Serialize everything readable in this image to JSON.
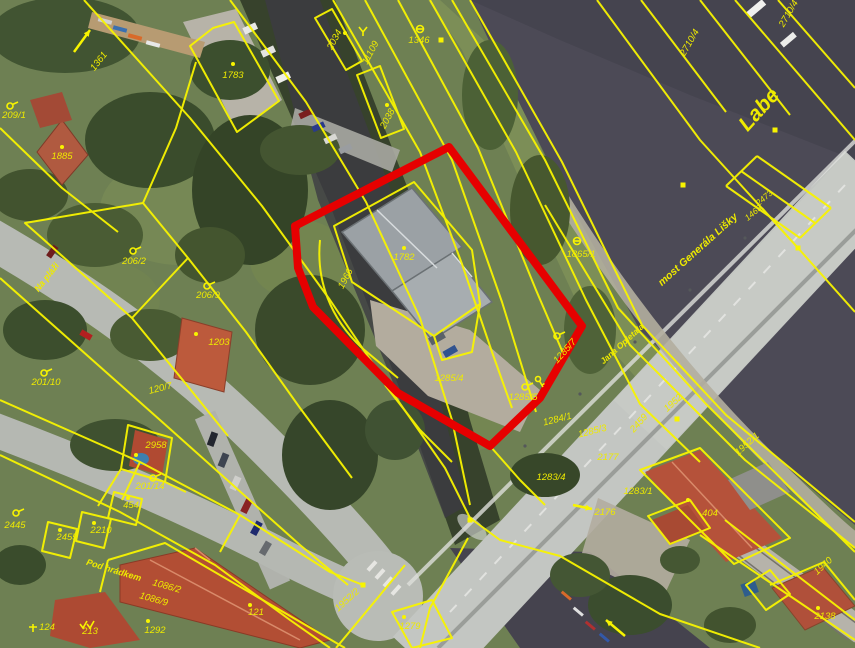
{
  "app": {
    "name": "cadastral-aerial-map-view"
  },
  "map": {
    "colors": {
      "cadastral_line": "#f8f400",
      "label_text": "#eeea00",
      "highlight_outline": "#e60000",
      "water": "#4c4a56",
      "road": "#bcbfb9",
      "grass": "#6e8053"
    },
    "highlighted_parcel_number": "1782",
    "river_name": "Labe",
    "bridge_name": "most Generála Lišky",
    "labels": [
      {
        "kind": "parcel",
        "text": "2034",
        "x": 337,
        "y": 41,
        "rot": -62
      },
      {
        "kind": "parcel",
        "text": "11109",
        "x": 373,
        "y": 54,
        "rot": -62
      },
      {
        "kind": "parcel",
        "text": "1346",
        "x": 419,
        "y": 43,
        "rot": 0
      },
      {
        "kind": "parcel",
        "text": "1783",
        "x": 233,
        "y": 78,
        "rot": 0
      },
      {
        "kind": "parcel",
        "text": "1361",
        "x": 101,
        "y": 63,
        "rot": -52
      },
      {
        "kind": "parcel",
        "text": "209/1",
        "x": 14,
        "y": 118,
        "rot": 0
      },
      {
        "kind": "parcel",
        "text": "1885",
        "x": 62,
        "y": 159,
        "rot": 0
      },
      {
        "kind": "parcel",
        "text": "2710/4",
        "x": 692,
        "y": 44,
        "rot": -60
      },
      {
        "kind": "parcel",
        "text": "2710/4",
        "x": 791,
        "y": 15,
        "rot": -60
      },
      {
        "kind": "river",
        "text": "Labe",
        "x": 764,
        "y": 114,
        "rot": -48,
        "size": 21
      },
      {
        "kind": "street",
        "text": "most Generála Lišky",
        "x": 700,
        "y": 252,
        "rot": -42,
        "size": 10.5
      },
      {
        "kind": "street",
        "text": "Jana Opletala",
        "x": 624,
        "y": 346,
        "rot": -42,
        "size": 8.5
      },
      {
        "kind": "parcel",
        "text": "2473",
        "x": 766,
        "y": 200,
        "rot": -40,
        "size": 8.5
      },
      {
        "kind": "parcel",
        "text": "1463",
        "x": 755,
        "y": 215,
        "rot": -40,
        "size": 8.5
      },
      {
        "kind": "parcel",
        "text": "1865/1",
        "x": 581,
        "y": 257,
        "rot": 0
      },
      {
        "kind": "parcel",
        "text": "2038",
        "x": 390,
        "y": 120,
        "rot": -62
      },
      {
        "kind": "parcel",
        "text": "1966",
        "x": 348,
        "y": 280,
        "rot": -62
      },
      {
        "kind": "parcel",
        "text": "1782",
        "x": 404,
        "y": 260,
        "rot": 0
      },
      {
        "kind": "parcel",
        "text": "1285/4",
        "x": 449,
        "y": 381,
        "rot": 0
      },
      {
        "kind": "parcel",
        "text": "1285/5",
        "x": 523,
        "y": 400,
        "rot": 0
      },
      {
        "kind": "parcel",
        "text": "1285/7",
        "x": 567,
        "y": 353,
        "rot": -48
      },
      {
        "kind": "parcel",
        "text": "206/2",
        "x": 134,
        "y": 264,
        "rot": 0
      },
      {
        "kind": "parcel",
        "text": "206/9",
        "x": 208,
        "y": 298,
        "rot": 0
      },
      {
        "kind": "parcel",
        "text": "1203",
        "x": 219,
        "y": 345,
        "rot": 0
      },
      {
        "kind": "parcel",
        "text": "120/7",
        "x": 161,
        "y": 391,
        "rot": -14
      },
      {
        "kind": "parcel",
        "text": "201/10",
        "x": 46,
        "y": 385,
        "rot": 0
      },
      {
        "kind": "street",
        "text": "Na pláži",
        "x": 49,
        "y": 279,
        "rot": -52,
        "size": 9
      },
      {
        "kind": "parcel",
        "text": "2445",
        "x": 15,
        "y": 528,
        "rot": 0
      },
      {
        "kind": "parcel",
        "text": "2455",
        "x": 67,
        "y": 540,
        "rot": 0
      },
      {
        "kind": "parcel",
        "text": "2210",
        "x": 101,
        "y": 533,
        "rot": 0
      },
      {
        "kind": "parcel",
        "text": "454",
        "x": 131,
        "y": 508,
        "rot": 0
      },
      {
        "kind": "parcel",
        "text": "2958",
        "x": 156,
        "y": 448,
        "rot": 0
      },
      {
        "kind": "parcel",
        "text": "201/14",
        "x": 150,
        "y": 489,
        "rot": 0
      },
      {
        "kind": "street",
        "text": "Pod hrádkem",
        "x": 113,
        "y": 573,
        "rot": 17,
        "size": 9
      },
      {
        "kind": "parcel",
        "text": "1086/2",
        "x": 166,
        "y": 589,
        "rot": 16
      },
      {
        "kind": "parcel",
        "text": "1086/9",
        "x": 153,
        "y": 602,
        "rot": 16
      },
      {
        "kind": "parcel",
        "text": "124",
        "x": 47,
        "y": 630,
        "rot": 0
      },
      {
        "kind": "parcel",
        "text": "213",
        "x": 90,
        "y": 634,
        "rot": 0
      },
      {
        "kind": "parcel",
        "text": "1292",
        "x": 155,
        "y": 633,
        "rot": 0
      },
      {
        "kind": "parcel",
        "text": "121",
        "x": 256,
        "y": 615,
        "rot": 0
      },
      {
        "kind": "parcel",
        "text": "1952/2",
        "x": 349,
        "y": 602,
        "rot": -42
      },
      {
        "kind": "parcel",
        "text": "1279",
        "x": 410,
        "y": 629,
        "rot": 0
      },
      {
        "kind": "parcel",
        "text": "1284/1",
        "x": 558,
        "y": 422,
        "rot": -14
      },
      {
        "kind": "parcel",
        "text": "1285/3",
        "x": 593,
        "y": 434,
        "rot": -14
      },
      {
        "kind": "parcel",
        "text": "2459",
        "x": 641,
        "y": 425,
        "rot": -48
      },
      {
        "kind": "parcel",
        "text": "2177",
        "x": 608,
        "y": 460,
        "rot": 0
      },
      {
        "kind": "parcel",
        "text": "1283/4",
        "x": 551,
        "y": 480,
        "rot": 0
      },
      {
        "kind": "parcel",
        "text": "1283/1",
        "x": 638,
        "y": 494,
        "rot": 0
      },
      {
        "kind": "parcel",
        "text": "2176",
        "x": 605,
        "y": 515,
        "rot": 0
      },
      {
        "kind": "parcel",
        "text": "404",
        "x": 710,
        "y": 516,
        "rot": 0
      },
      {
        "kind": "parcel",
        "text": "1952",
        "x": 675,
        "y": 405,
        "rot": -42
      },
      {
        "kind": "parcel",
        "text": "1952/1",
        "x": 749,
        "y": 446,
        "rot": -42
      },
      {
        "kind": "parcel",
        "text": "1940",
        "x": 825,
        "y": 568,
        "rot": -42
      },
      {
        "kind": "parcel",
        "text": "2138",
        "x": 825,
        "y": 619,
        "rot": 0
      }
    ],
    "icons": [
      {
        "type": "theta",
        "x": 420,
        "y": 29
      },
      {
        "type": "theta",
        "x": 577,
        "y": 241
      },
      {
        "type": "pin",
        "x": 10,
        "y": 106
      },
      {
        "type": "pin",
        "x": 133,
        "y": 251
      },
      {
        "type": "pin",
        "x": 207,
        "y": 286
      },
      {
        "type": "pin",
        "x": 44,
        "y": 373
      },
      {
        "type": "pin",
        "x": 153,
        "y": 478
      },
      {
        "type": "pin",
        "x": 16,
        "y": 513
      },
      {
        "type": "pin",
        "x": 557,
        "y": 336
      },
      {
        "type": "pin",
        "x": 525,
        "y": 387
      },
      {
        "type": "key",
        "x": 538,
        "y": 379
      },
      {
        "type": "cross",
        "x": 33,
        "y": 628
      },
      {
        "type": "check",
        "x": 84,
        "y": 624
      },
      {
        "type": "tree",
        "x": 363,
        "y": 30
      },
      {
        "type": "arrow",
        "x1": 74,
        "y1": 52,
        "x2": 90,
        "y2": 30
      },
      {
        "type": "arrow",
        "x1": 625,
        "y1": 636,
        "x2": 606,
        "y2": 620
      },
      {
        "type": "arrow",
        "x1": 573,
        "y1": 505,
        "x2": 592,
        "y2": 509
      }
    ],
    "center_dots": [
      {
        "x": 233,
        "y": 64
      },
      {
        "x": 404,
        "y": 248
      },
      {
        "x": 196,
        "y": 334
      },
      {
        "x": 62,
        "y": 147
      },
      {
        "x": 136,
        "y": 455
      },
      {
        "x": 128,
        "y": 498
      },
      {
        "x": 94,
        "y": 523
      },
      {
        "x": 60,
        "y": 530
      },
      {
        "x": 688,
        "y": 500
      },
      {
        "x": 818,
        "y": 608
      },
      {
        "x": 404,
        "y": 617
      },
      {
        "x": 250,
        "y": 605
      },
      {
        "x": 148,
        "y": 621
      },
      {
        "x": 345,
        "y": 33
      },
      {
        "x": 387,
        "y": 105
      }
    ],
    "vertex_squares": [
      {
        "x": 798,
        "y": 248
      },
      {
        "x": 775,
        "y": 130
      },
      {
        "x": 683,
        "y": 185
      },
      {
        "x": 363,
        "y": 585
      },
      {
        "x": 470,
        "y": 520
      },
      {
        "x": 441,
        "y": 40
      },
      {
        "x": 677,
        "y": 419
      }
    ]
  }
}
